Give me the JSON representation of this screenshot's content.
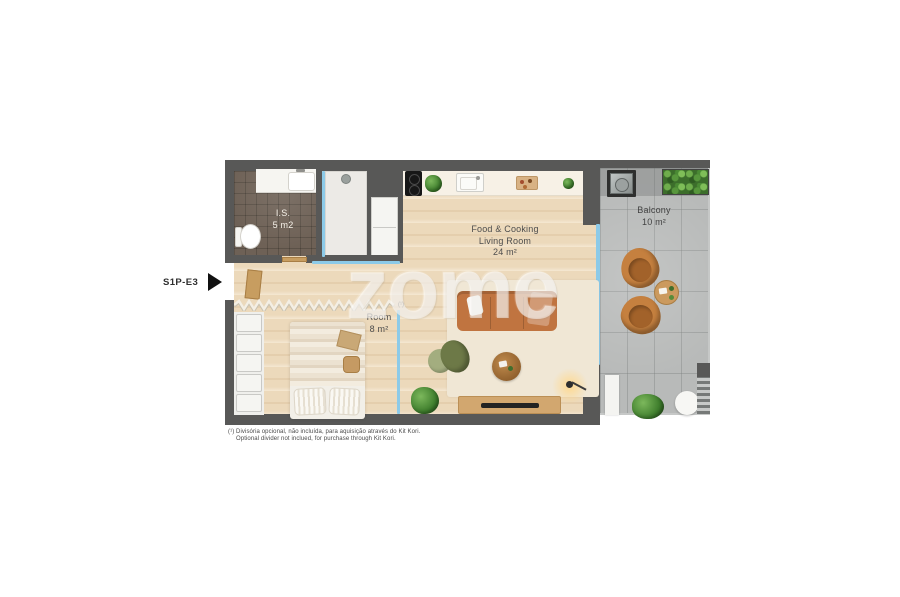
{
  "unit": {
    "label": "S1P-E3"
  },
  "watermark": {
    "text": "zome"
  },
  "rooms": {
    "bathroom": {
      "name": "I.S.",
      "area": "5 m2",
      "items": [
        "vanity-sink",
        "toilet",
        "shower"
      ]
    },
    "living": {
      "name_line1": "Food & Cooking",
      "name_line2": "Living Room",
      "area": "24 m²",
      "items": [
        "cooktop",
        "kitchen-sink",
        "cutting-board",
        "fridge-cabinet",
        "sofa",
        "rug",
        "armchair",
        "pouf",
        "coffee-table",
        "floor-lamp",
        "plant",
        "tv-console",
        "tv"
      ]
    },
    "bedroom": {
      "name": "Room",
      "area": "8 m²",
      "divider_marker": "(¹)",
      "items": [
        "wardrobe",
        "double-bed",
        "pillows",
        "bedside-stool",
        "optional-divider"
      ]
    },
    "balcony": {
      "name": "Balcony",
      "area": "10 m²",
      "items": [
        "outdoor-sink",
        "planter-hedge",
        "lounge-chair",
        "lounge-chair",
        "side-table",
        "plant",
        "round-table",
        "bench",
        "drain-grate"
      ]
    }
  },
  "footnotes": {
    "pt": "(¹) Divisória opcional, não incluída, para aquisição através do Kit Kori.",
    "en": "Optional divider not inclued, for purchase through Kit Kori."
  },
  "colors": {
    "wall": "#585857",
    "wood_floor": "#ecd9bb",
    "bathroom_tile": "#6e6156",
    "balcony_tile": "#b8bab9",
    "glass": "#8ccae8",
    "furniture_accent": "#c5803f",
    "label_text": "#4d4d4d"
  }
}
